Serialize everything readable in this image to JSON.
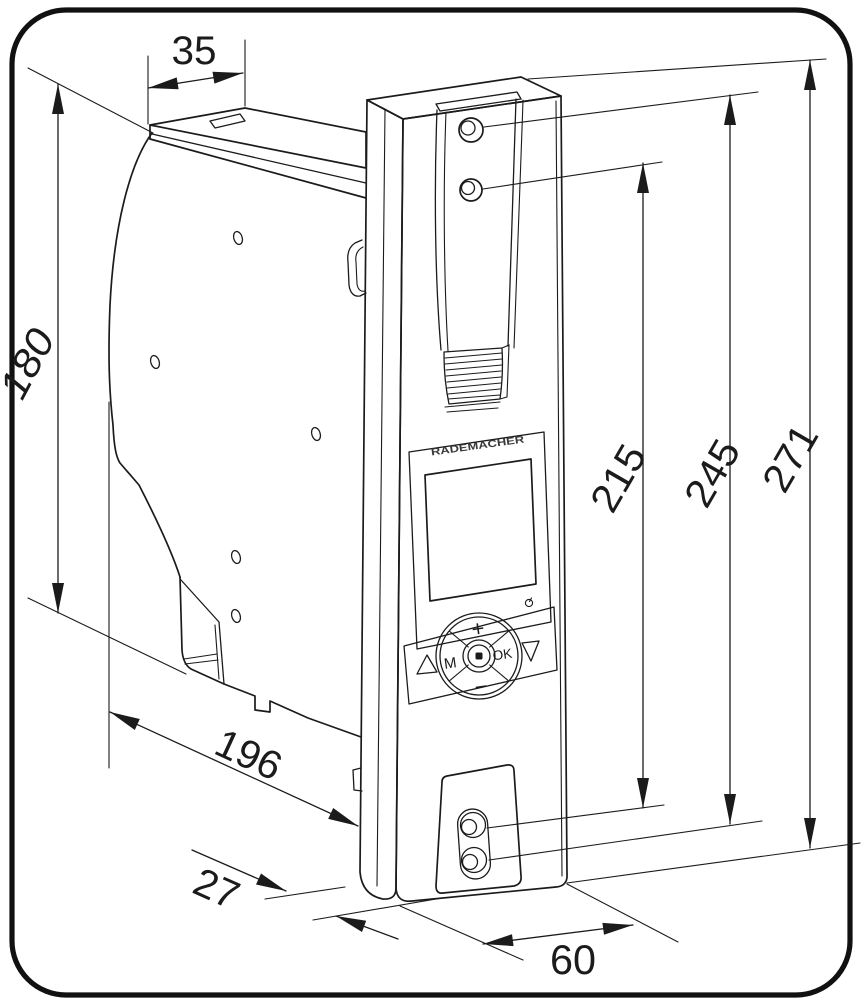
{
  "figure": {
    "kind": "dimensional-drawing",
    "brand": "RADEMACHER",
    "dimensions_mm": {
      "d35": "35",
      "d180": "180",
      "d196": "196",
      "d27": "27",
      "d60": "60",
      "d215": "215",
      "d245": "245",
      "d271": "271"
    },
    "keypad": {
      "plus": "+",
      "minus": "−",
      "menu": "M",
      "ok": "OK"
    },
    "icons": {
      "up": "triangle-up-icon",
      "down": "triangle-down-icon",
      "center": "stop-button-icon",
      "power": "power-indicator-icon"
    },
    "colors": {
      "line": "#1b1b1b",
      "frame": "#111111",
      "background": "#ffffff"
    }
  }
}
